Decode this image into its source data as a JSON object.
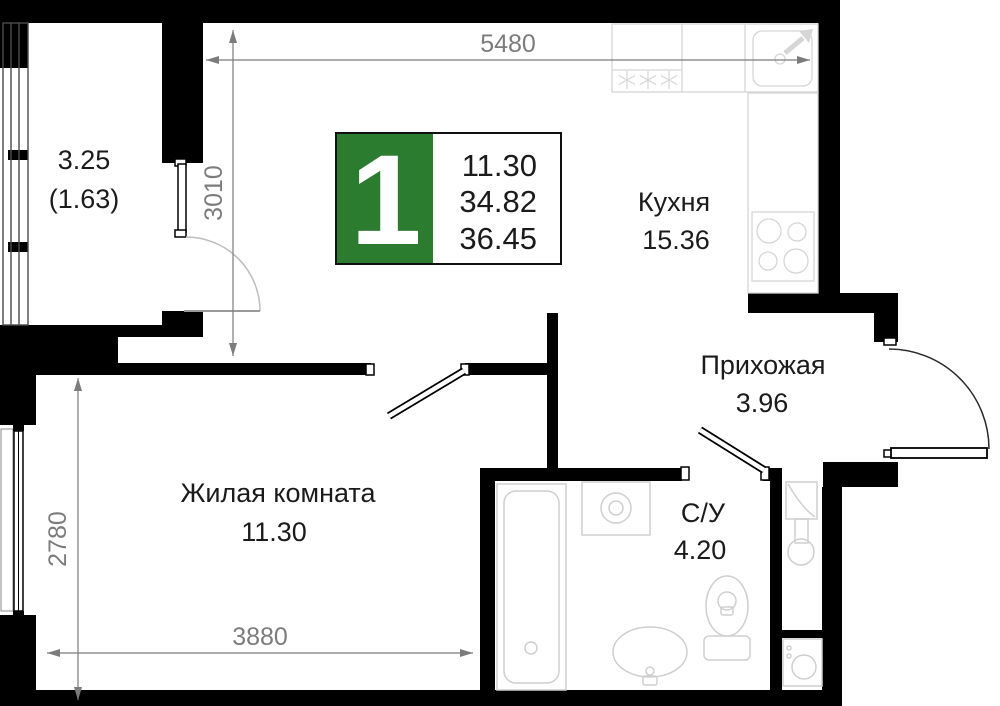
{
  "badge": {
    "rooms_count": "1",
    "accent_color": "#2b7c2f",
    "values": [
      "11.30",
      "34.82",
      "36.45"
    ]
  },
  "rooms": {
    "balcony": {
      "area": "3.25",
      "area_reduced": "(1.63)"
    },
    "kitchen": {
      "name": "Кухня",
      "area": "15.36"
    },
    "hallway": {
      "name": "Прихожая",
      "area": "3.96"
    },
    "living_room": {
      "name": "Жилая комната",
      "area": "11.30"
    },
    "bathroom": {
      "name": "С/У",
      "area": "4.20"
    }
  },
  "dimensions_mm": {
    "kitchen_width": "5480",
    "balcony_wall": "3010",
    "living_depth": "2780",
    "living_width": "3880"
  }
}
